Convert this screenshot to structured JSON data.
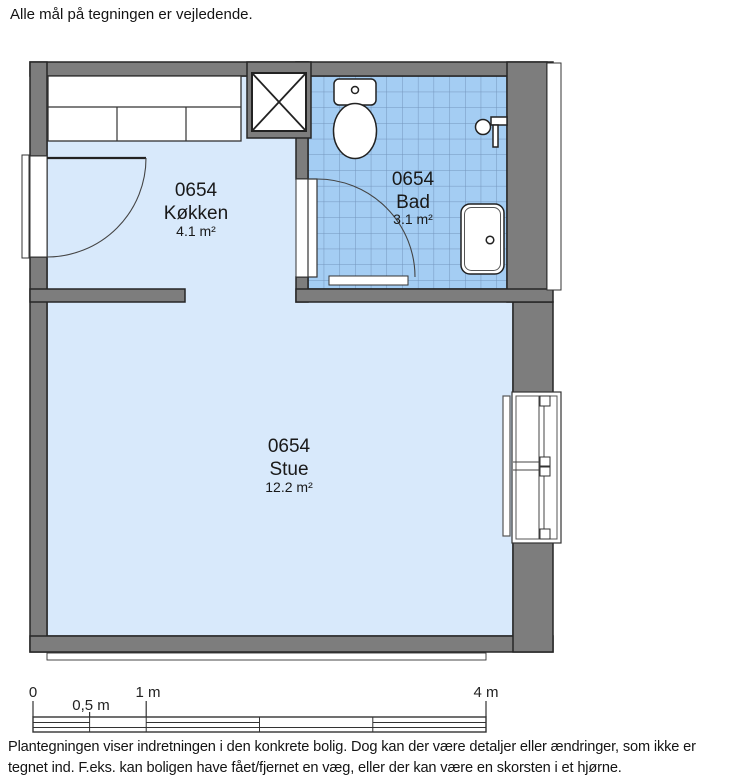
{
  "header": {
    "note": "Alle mål på tegningen er vejledende."
  },
  "rooms": [
    {
      "id": "0654",
      "name": "Køkken",
      "area": "4.1 m²"
    },
    {
      "id": "0654",
      "name": "Bad",
      "area": "3.1 m²"
    },
    {
      "id": "0654",
      "name": "Stue",
      "area": "12.2 m²"
    }
  ],
  "scale_bar": {
    "labels": [
      "0",
      "0,5 m",
      "1 m",
      "4 m"
    ]
  },
  "footer": {
    "disclaimer": "Plantegningen viser indretningen i den konkrete bolig. Dog kan der være detaljer eller ændringer, som ikke er tegnet ind. F.eks. kan boligen have fået/fjernet en væg, eller der kan være en skorsten i et hjørne."
  },
  "colors": {
    "wall": "#7d7d7d",
    "outline": "#262626",
    "floor": "#d8e9fb",
    "bath_tile": "#a4cdf3",
    "bath_tile_line": "#7495bd"
  }
}
